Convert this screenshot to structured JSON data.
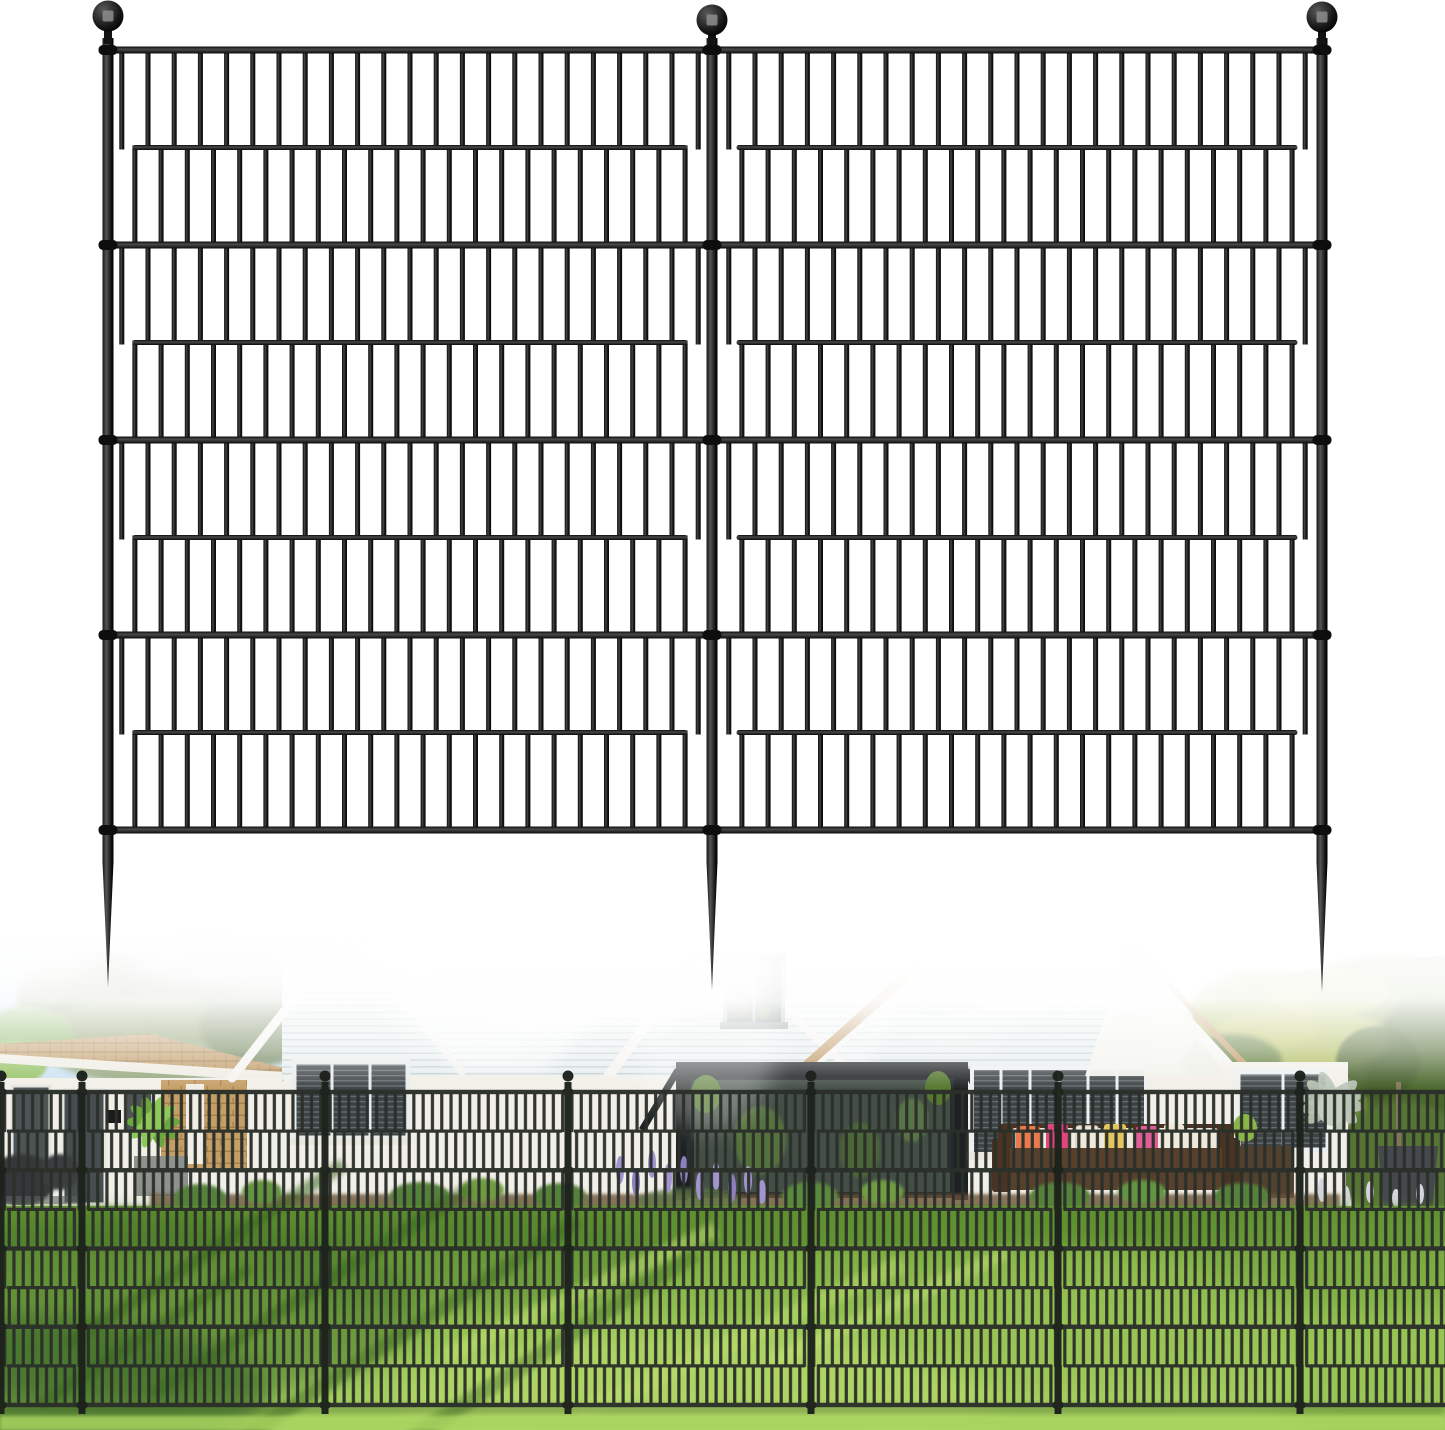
{
  "canvas": {
    "width": 1445,
    "height": 1430,
    "background": "#ffffff"
  },
  "palette": {
    "fence_black": "#131313",
    "fence_collar": "#0e0e0e",
    "ball_glint": "#8d8d8d",
    "photo_fence": "#2b302a",
    "photo_fence_post": "#1d221c",
    "sky_top": "#9fc3e7",
    "sky_bottom": "#d9eaf6",
    "pine_green": "#64784a",
    "pine_dark": "#55693f",
    "pine_light": "#8a9c66",
    "bright_tree": "#7fae57",
    "hedge_green": "#6f8c3e",
    "hedge_light": "#aab851",
    "hedge_yellow": "#c2c964",
    "hedge_dark": "#47632a",
    "roof_shingle": "#c09a64",
    "roof_shadow": "#8d6f45",
    "roof_tan_edge": "#bb9058",
    "fascia_white": "#f4f3ef",
    "wall_white": "#f2efe8",
    "brick_tan": "#c59e66",
    "brick_joint": "#9a7847",
    "siding_face": "#e7edee",
    "siding_groove": "#c2ced2",
    "window_dark": "#3d4346",
    "window_frame": "#eceff0",
    "door_gray": "#4e5456",
    "porch_dark": "#262b2d",
    "porch_beam": "#1d2123",
    "glass_green": "#434e46",
    "plant_green": "#55772f",
    "palm_green": "#6aa83e",
    "palm_light": "#8cc957",
    "lawn_back": "#6fa238",
    "lawn_mid": "#96c452",
    "lawn_front": "#abd364",
    "lawn_streak": "#c3e273",
    "lawn_shadow": "#38661f",
    "lawn_dark_blob": "#3f6e28",
    "mulch": "#6d5339",
    "bush_green": "#55823a",
    "bush_light": "#6f9c42",
    "lavender": "#a194cf",
    "lavender_pale": "#d6d4de",
    "path_light": "#e6e3d8",
    "sofa_brown": "#57402c",
    "sofa_back": "#4a3323",
    "cushion_cream": "#efe9dc",
    "pillow_pink": "#e2457c",
    "pillow_orange": "#e87a4e",
    "pillow_yellow": "#e3c65f",
    "pillow_rose": "#de5f95",
    "planter_gray": "#45484c",
    "planter_brown": "#51412f",
    "planter_pale": "#8e918c",
    "agave_pale": "#b7c3b4",
    "agave_core": "#c4cfc1",
    "step_white": "#e9e7df"
  },
  "product_fence": {
    "posts_x": [
      108,
      712,
      1322
    ],
    "post_width": 11,
    "post_top_y": 38,
    "ball_cy": [
      16,
      20,
      17
    ],
    "ball_r": 15.5,
    "stake_taper_y": 862,
    "stake_tip_y": [
      987,
      990,
      992
    ],
    "rails": {
      "top_y": 50,
      "bottom_y": 830,
      "bands": 8,
      "full_h": 7,
      "inset_h": 5,
      "inset_margin": 19
    },
    "bars": {
      "pitch": 26.2,
      "width": 5,
      "edge_margin": 6
    },
    "panels": [
      {
        "x1": 113.5,
        "x2": 706.5
      },
      {
        "x1": 717.5,
        "x2": 1316.5
      }
    ]
  },
  "photo_fence": {
    "posts_x": [
      1,
      82,
      325,
      568,
      811,
      1058,
      1300
    ],
    "post_width": 7,
    "post_top_y": 1082,
    "post_bottom_y": 1414,
    "cap_cy": 1076,
    "cap_r": 5.5,
    "rails": {
      "top_y": 1092,
      "bottom_y": 1405,
      "bands": 8,
      "full_h": 4.4,
      "inset_h": 3.2,
      "post_gap": 6
    },
    "bars": {
      "pitch": 9.3,
      "width": 3.2
    }
  },
  "photo": {
    "top_y": 940,
    "fade_rect_y": 926,
    "fade_rect_h": 164,
    "lawn_top_y": 1206
  }
}
